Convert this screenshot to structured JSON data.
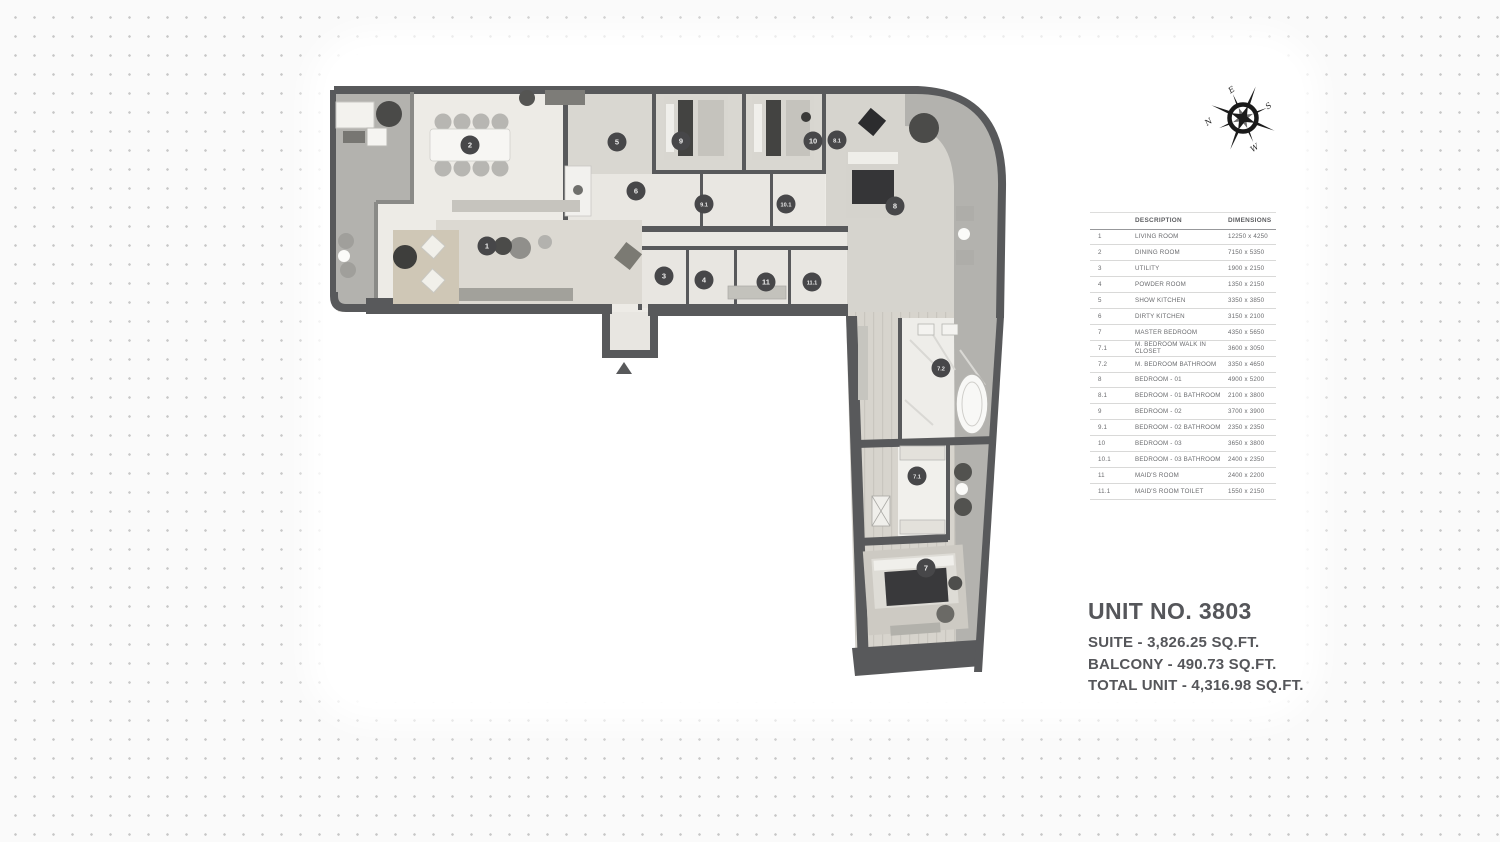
{
  "compass": {
    "north": "N",
    "east": "E",
    "south": "S",
    "west": "W"
  },
  "schedule_table": {
    "headers": {
      "description": "DESCRIPTION",
      "dimensions": "DIMENSIONS"
    },
    "rows": [
      {
        "no": "1",
        "description": "LIVING ROOM",
        "dimensions": "12250 x 4250"
      },
      {
        "no": "2",
        "description": "DINING ROOM",
        "dimensions": "7150 x 5350"
      },
      {
        "no": "3",
        "description": "UTILITY",
        "dimensions": "1900 x 2150"
      },
      {
        "no": "4",
        "description": "POWDER ROOM",
        "dimensions": "1350 x 2150"
      },
      {
        "no": "5",
        "description": "SHOW KITCHEN",
        "dimensions": "3350 x 3850"
      },
      {
        "no": "6",
        "description": "DIRTY KITCHEN",
        "dimensions": "3150 x 2100"
      },
      {
        "no": "7",
        "description": "MASTER BEDROOM",
        "dimensions": "4350 x 5650"
      },
      {
        "no": "7.1",
        "description": "M. BEDROOM WALK IN CLOSET",
        "dimensions": "3600 x 3050"
      },
      {
        "no": "7.2",
        "description": "M. BEDROOM BATHROOM",
        "dimensions": "3350 x 4650"
      },
      {
        "no": "8",
        "description": "BEDROOM - 01",
        "dimensions": "4900 x 5200"
      },
      {
        "no": "8.1",
        "description": "BEDROOM -  01 BATHROOM",
        "dimensions": "2100 x 3800"
      },
      {
        "no": "9",
        "description": "BEDROOM - 02",
        "dimensions": "3700 x 3900"
      },
      {
        "no": "9.1",
        "description": "BEDROOM - 02 BATHROOM",
        "dimensions": "2350 x 2350"
      },
      {
        "no": "10",
        "description": "BEDROOM - 03",
        "dimensions": "3650 x 3800"
      },
      {
        "no": "10.1",
        "description": "BEDROOM - 03 BATHROOM",
        "dimensions": "2400 x 2350"
      },
      {
        "no": "11",
        "description": "MAID'S ROOM",
        "dimensions": "2400 x 2200"
      },
      {
        "no": "11.1",
        "description": "MAID'S ROOM TOILET",
        "dimensions": "1550 x 2150"
      }
    ]
  },
  "unit_info": {
    "unit_no": "UNIT NO. 3803",
    "suite": "SUITE - 3,826.25 SQ.FT.",
    "balcony": "BALCONY - 490.73 SQ.FT.",
    "total": "TOTAL UNIT - 4,316.98 SQ.FT."
  },
  "floor_plan": {
    "colors": {
      "wall": "#58595b",
      "balcony": "#b3b2ae",
      "marker": "#474749"
    },
    "markers": [
      {
        "label": "1",
        "x": 487,
        "y": 246
      },
      {
        "label": "2",
        "x": 470,
        "y": 145
      },
      {
        "label": "3",
        "x": 664,
        "y": 276
      },
      {
        "label": "4",
        "x": 704,
        "y": 280
      },
      {
        "label": "5",
        "x": 617,
        "y": 142
      },
      {
        "label": "6",
        "x": 636,
        "y": 191
      },
      {
        "label": "7",
        "x": 926,
        "y": 568
      },
      {
        "label": "7.1",
        "x": 917,
        "y": 476
      },
      {
        "label": "7.2",
        "x": 941,
        "y": 368
      },
      {
        "label": "8",
        "x": 895,
        "y": 206
      },
      {
        "label": "8.1",
        "x": 837,
        "y": 140
      },
      {
        "label": "9",
        "x": 681,
        "y": 141
      },
      {
        "label": "9.1",
        "x": 704,
        "y": 204
      },
      {
        "label": "10",
        "x": 813,
        "y": 141
      },
      {
        "label": "10.1",
        "x": 786,
        "y": 204
      },
      {
        "label": "11",
        "x": 766,
        "y": 282
      },
      {
        "label": "11.1",
        "x": 812,
        "y": 282
      }
    ]
  }
}
